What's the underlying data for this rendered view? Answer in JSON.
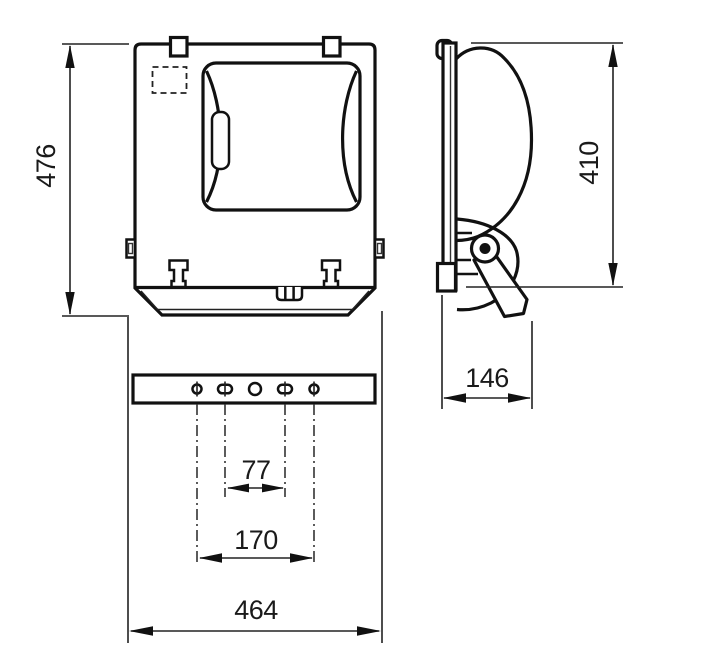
{
  "dimension_labels": {
    "front_height": "476",
    "side_height": "410",
    "side_depth": "146",
    "slot_spacing": "77",
    "hole_spacing": "170",
    "overall_width": "464"
  }
}
